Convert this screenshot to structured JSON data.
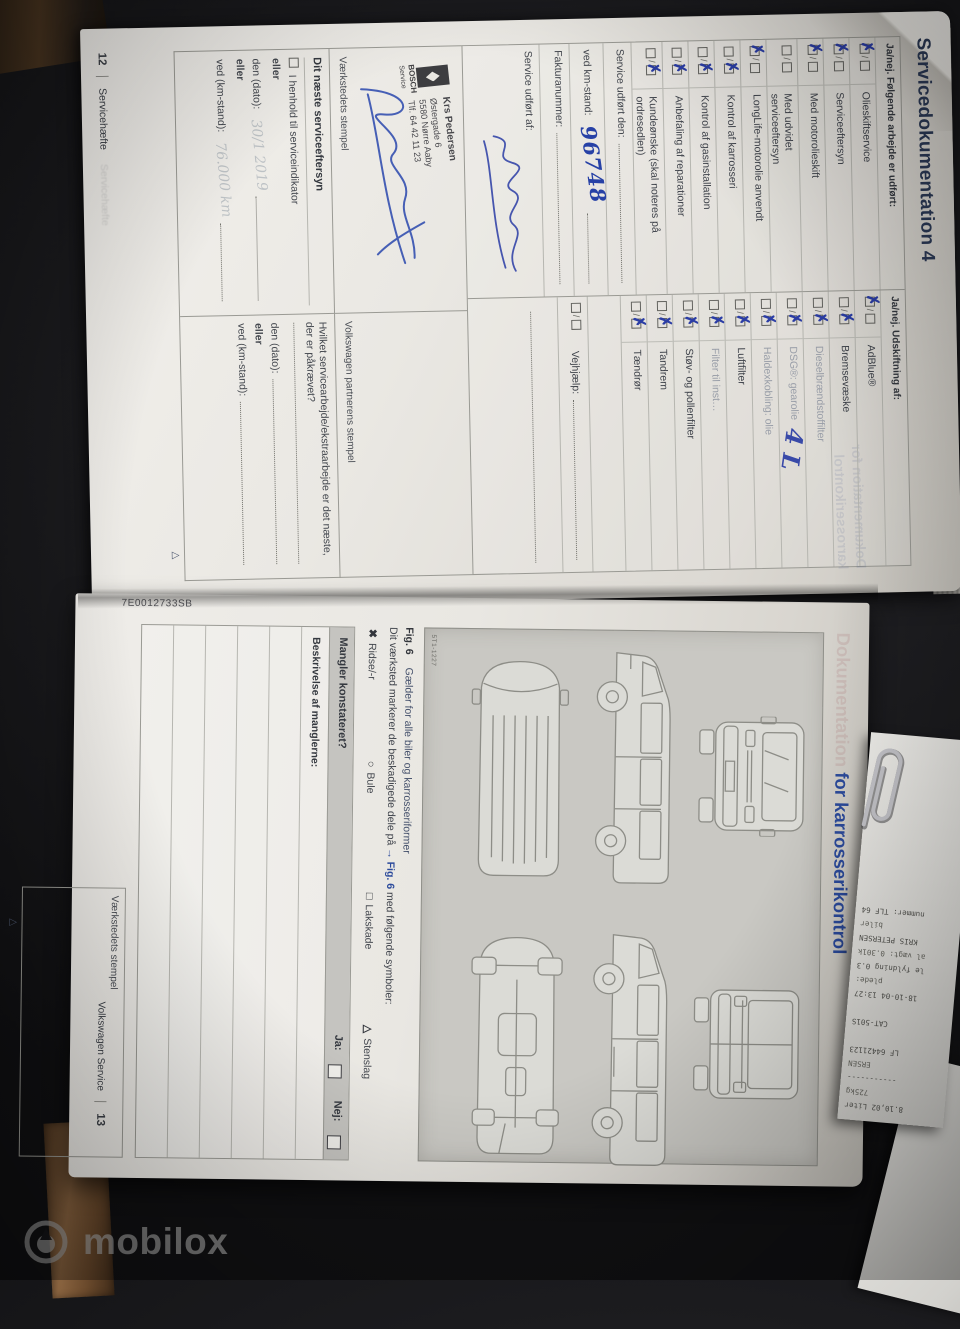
{
  "page12": {
    "title": "Servicedokumentation 4",
    "ghost_title": "Dokumentation for karrosserikontrol",
    "footer_page": "12",
    "footer_label": "Servicehæfte",
    "group_a_header": "Ja/nej. Følgende arbejde er udført:",
    "group_b_header": "Ja/nej. Udskiftning af:",
    "rows_a": [
      {
        "label": "Olieskiftservice",
        "state": "ja"
      },
      {
        "label": "Serviceeftersyn",
        "state": "ja"
      },
      {
        "label": "Med motorolieskift",
        "state": "ja"
      },
      {
        "label": "Med udvidet serviceeftersyn",
        "state": "none",
        "wrap": true
      },
      {
        "label": "LongLife-motorolie anvendt",
        "state": "ja"
      },
      {
        "label": "Kontrol af karrosseri",
        "state": "nej"
      },
      {
        "label": "Kontrol af gasinstallation",
        "state": "nej"
      },
      {
        "label": "Anbefaling af reparationer",
        "state": "nej"
      },
      {
        "label": "Kundeønske (skal noteres på ordresedlen)",
        "state": "nej"
      }
    ],
    "rows_b": [
      {
        "label": "AdBlue®",
        "state": "ja"
      },
      {
        "label": "Bremsevæske",
        "state": "nej"
      },
      {
        "label": "Dieselbrændstoffilter",
        "state": "nej",
        "muted": true
      },
      {
        "label": "DSG®: gearolie",
        "state": "nej",
        "muted": true
      },
      {
        "label": "Haldexkobling: olie",
        "state": "nej",
        "muted": true
      },
      {
        "label": "Luftfilter",
        "state": "nej"
      },
      {
        "label": "Filter til inst…",
        "state": "nej",
        "muted": true
      },
      {
        "label": "Støv- og pollenfilter",
        "state": "nej"
      },
      {
        "label": "Tandrem",
        "state": "nej"
      },
      {
        "label": "Tændrør",
        "state": "nej"
      }
    ],
    "service_done_label": "Service udført den:",
    "km_label": "ved km-stand:",
    "km_value": "96748",
    "invoice_label": "Fakturanummer:",
    "vejhjaelp_label": "Vejhjælp:",
    "service_by_label": "Service udført af:",
    "adblue_note": "4 L",
    "stamp_left_label": "Værkstedets stempel",
    "stamp_right_label": "Volkswagen partnerens stempel",
    "stamp": {
      "name": "Krs Pedersen",
      "line2": "Østergade 6",
      "line3": "5580 Nørre Aaby",
      "line4": "Tlf. 64 42 11 23",
      "brand": "BOSCH",
      "brand_sub": "Service"
    },
    "next_service": {
      "title": "Dit næste serviceeftersyn",
      "indicator": "I henhold til serviceindikator",
      "or1": "eller",
      "date_label": "den (dato):",
      "or2": "eller",
      "km_label": "ved (km-stand):",
      "pencil_date": "30/1 2019",
      "pencil_km": "76.000 km"
    },
    "next_work": {
      "question": "Hvilket servicearbejde/ekstraarbejde er det næste, der er påkrævet?",
      "date_label": "den (dato):",
      "or": "eller",
      "km_label": "ved (km-stand):"
    },
    "triangle": "△"
  },
  "page13": {
    "title_faint": "Dokumentation",
    "title_strong": "for karrosserikontrol",
    "edge_code": "7E0012733SB",
    "fig_code": "5T1-1227",
    "fig_label": "Fig. 6",
    "fig_caption": "Gælder for alle biler og karrosseriformer",
    "marker_text_1": "Dit værksted markerer de beskadigede dele på",
    "marker_fig": "→ Fig. 6",
    "marker_text_2": "med følgende symboler:",
    "symbols": [
      {
        "glyph": "✖",
        "label": "Ridse/-r"
      },
      {
        "glyph": "○",
        "label": "Bule"
      },
      {
        "glyph": "□",
        "label": "Lakskade"
      },
      {
        "glyph": "△",
        "label": "Stenslag"
      }
    ],
    "defects_question": "Mangler konstateret?",
    "yes_label": "Ja:",
    "no_label": "Nej:",
    "description_label": "Beskrivelse af manglerne:",
    "stamp_label": "Værkstedets stempel",
    "footer_brand": "Volkswagen Service",
    "footer_page": "13",
    "triangle": "△"
  },
  "receipt": {
    "lines": [
      "8.10,02 Liter",
      "725kg",
      "-----------",
      "ERSEN",
      "LF 64421123",
      "",
      "CAT-501S",
      "",
      "18-10-04 13:27",
      "plede:",
      "le fyldning 0.3",
      "al vægt: 0.301k",
      "KRIS PETERSEN",
      "biler",
      "nummer: TLF 64"
    ]
  },
  "watermark": {
    "brand": "mobilox"
  }
}
